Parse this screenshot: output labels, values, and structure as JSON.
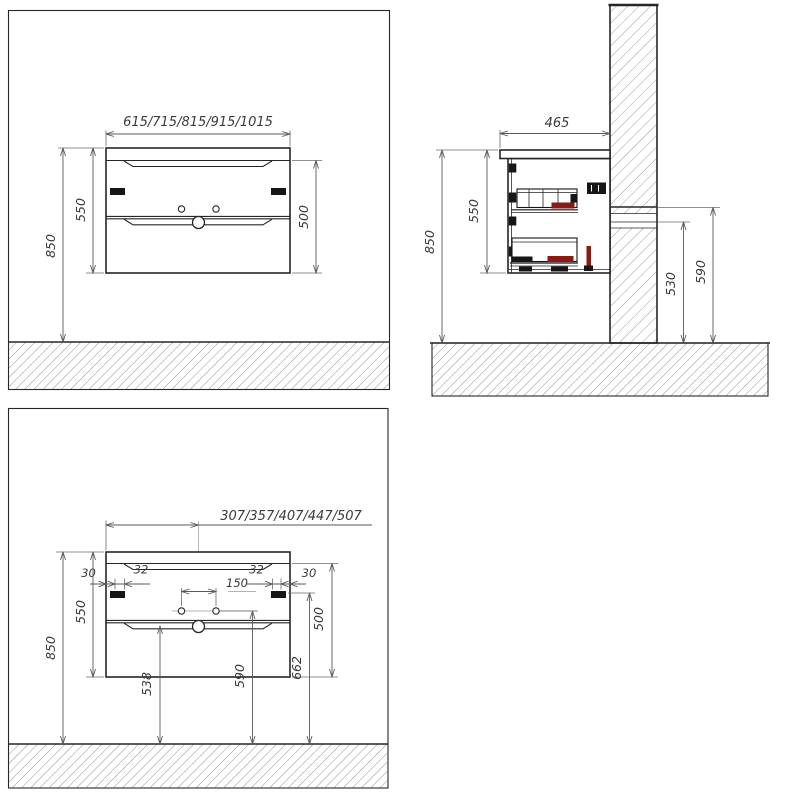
{
  "drawing": {
    "front_view": {
      "width_options": "615/715/815/915/1015",
      "cabinet_height": "550",
      "mounting_height": "850",
      "drawer_block_height": "500"
    },
    "side_view": {
      "depth": "465",
      "cabinet_height": "550",
      "mounting_height": "850",
      "drain_outlet_height": "530",
      "water_supply_height": "590"
    },
    "detail_view": {
      "center_offset_options": "307/357/407/447/507",
      "side_inset_left": "30",
      "side_inset_right": "30",
      "groove_inset_left": "32",
      "groove_inset_right": "32",
      "faucet_hole_spacing": "150",
      "cabinet_height": "550",
      "mounting_height": "850",
      "drawer_block_height": "500",
      "handle_axis_height": "662",
      "faucet_hole_height": "590",
      "lower_groove_height": "538"
    },
    "colors": {
      "line": "#262626",
      "dimension": "#5a5a5a",
      "hardware_black": "#161616",
      "accent_red": "#8a1a12"
    }
  }
}
